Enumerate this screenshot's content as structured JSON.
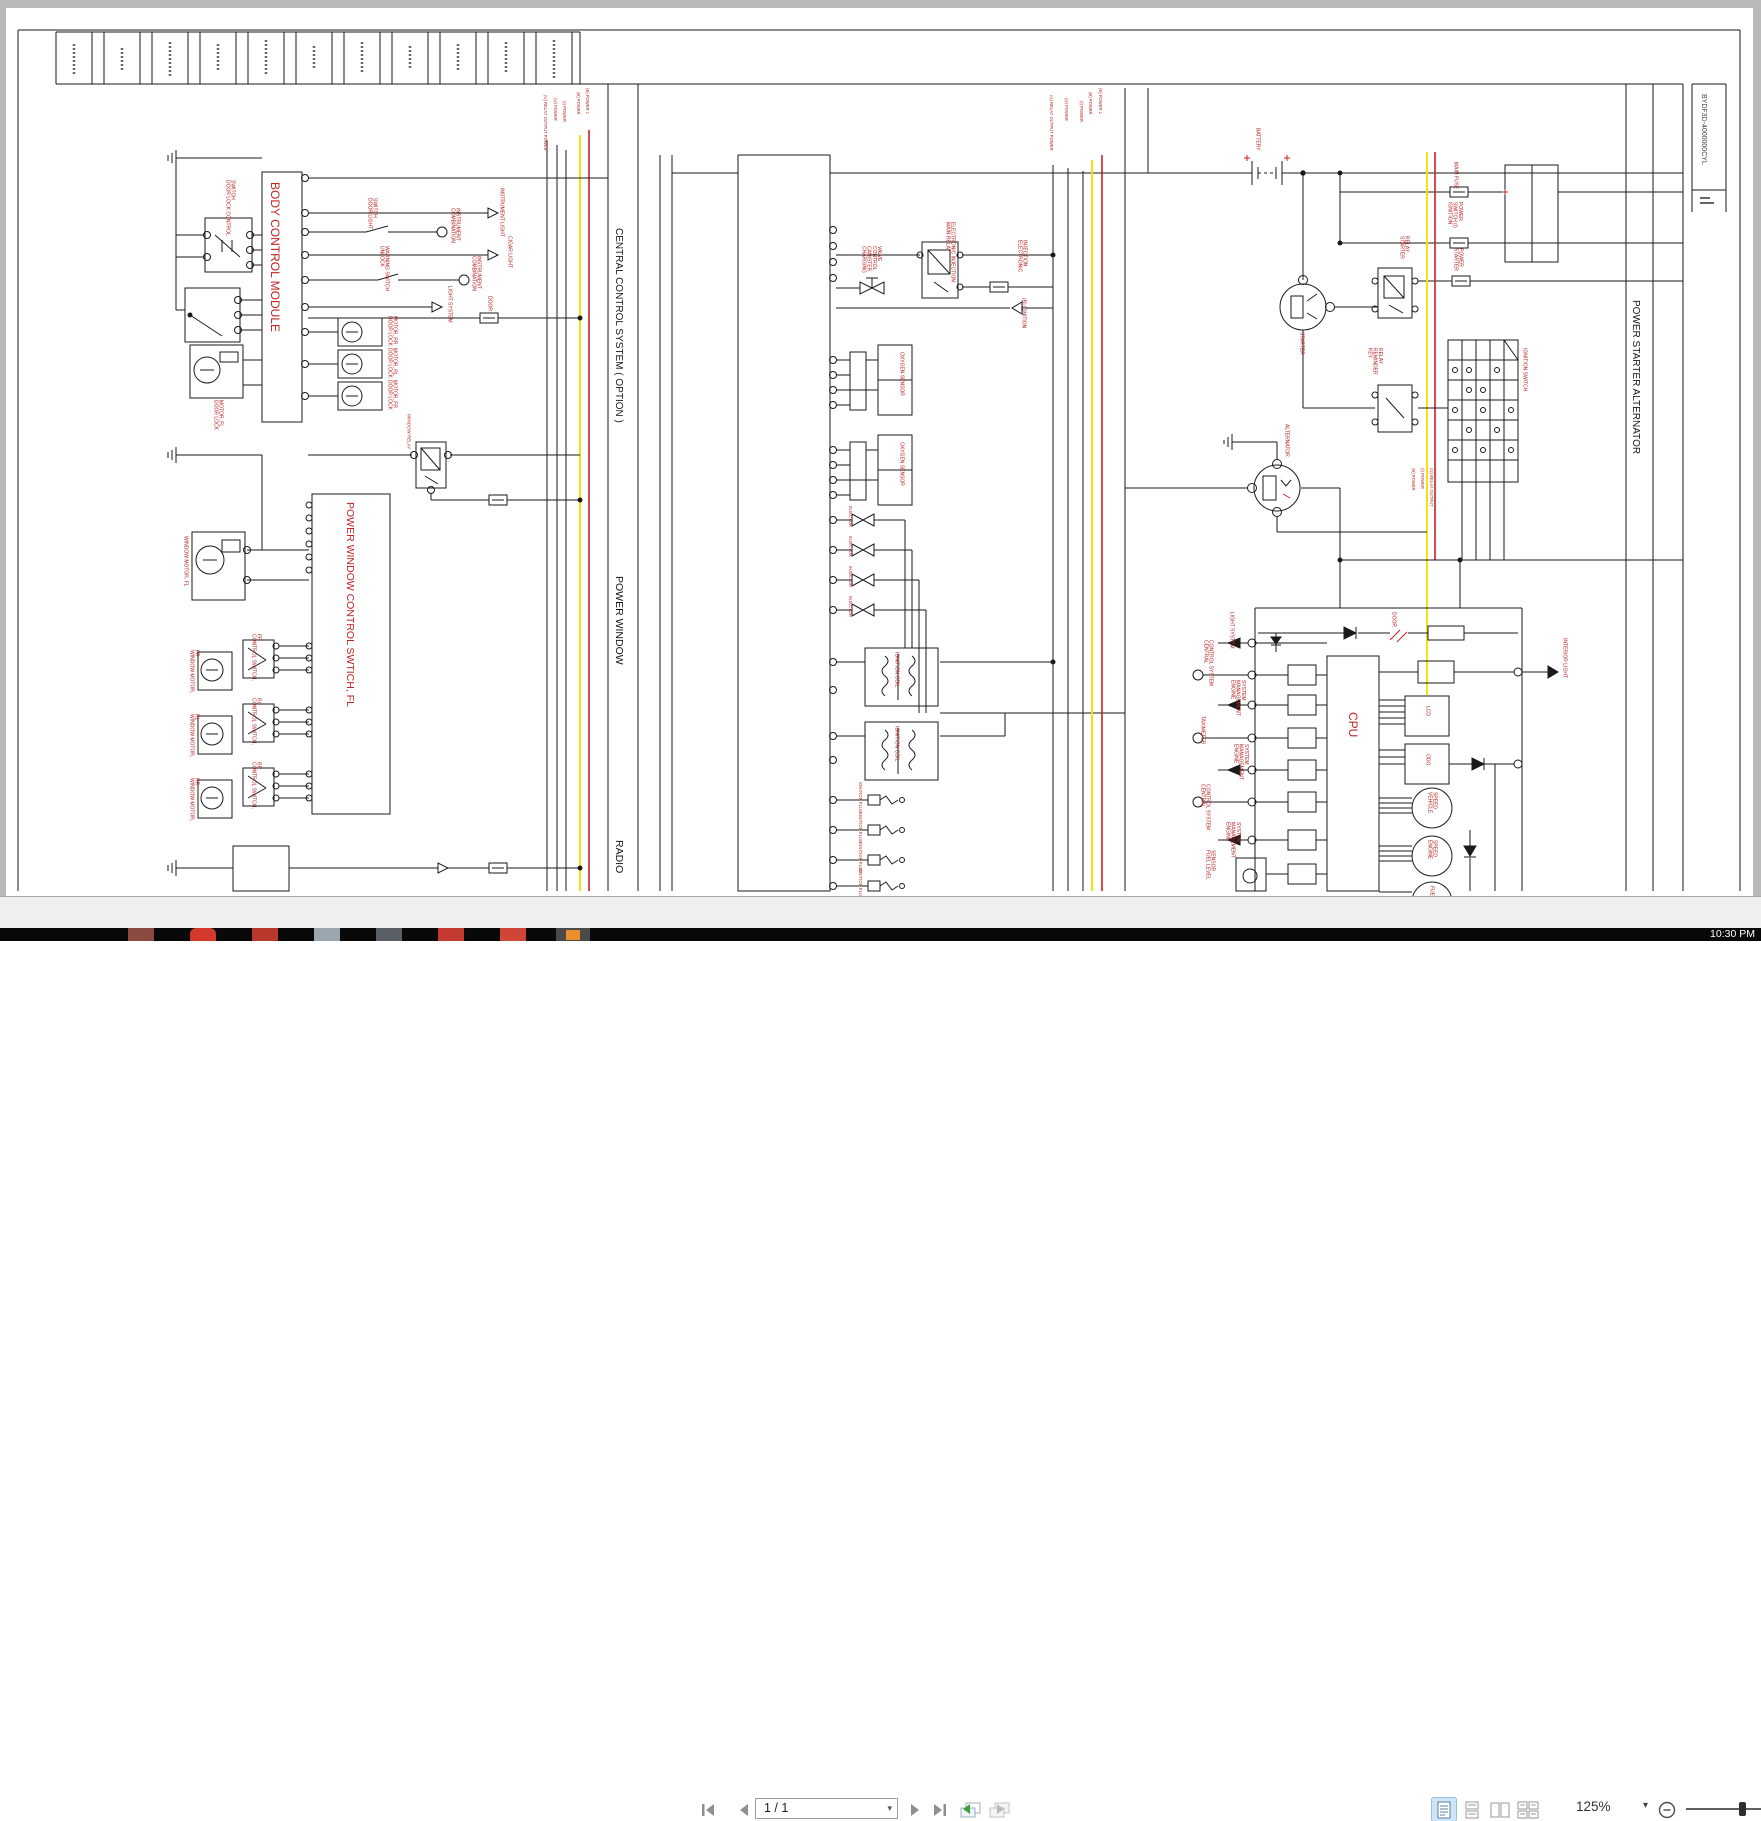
{
  "drawing": {
    "number": "BYDF3D-4000000CYL",
    "sections": {
      "central_control": "CENTRAL CONTROL SYSTEM ( OPTION )",
      "power_window": "POWER WINDOW",
      "radio": "RADIO",
      "power_starter_alternator": "POWER STARTER ALTERNATOR"
    },
    "bus_left": [
      "(U) RELAY OUTPUT POWER",
      "(U) POWER",
      "(I) POWER",
      "(B) POWER",
      "(B) POWER 1"
    ],
    "bus_mid": [
      "(U) RELAY OUTPUT POWER",
      "(U) POWER",
      "(I) POWER",
      "(B) POWER",
      "(B) POWER 1"
    ],
    "bus_right": [
      "(B) POWER",
      "(I) POWER",
      "(U) RELAY OUTPUT"
    ],
    "labels": {
      "bcm": "BODY CONTROL MODULE",
      "pwcs": "POWER WINDOW CONTROL SWTICH, FL",
      "door_lock_control_switch": "DOOR LOCK CONTROL SWITCH",
      "door_light_switch": "DOOR LIGHT SWITCH",
      "unlock_warning_switch": "UNLOCK WARNING SWITCH",
      "combination_instrument": "COMBINATION INSTRUMENT",
      "light_system": "LIGHT SYSTEM",
      "door": "DOOR",
      "instrument_light": "INSTRUMENT LIGHT",
      "cigar_light": "CIGAR LIGHT",
      "door_lock_motor_rr": "DOOR LOCK MOTOR, RR",
      "door_lock_motor_rl": "DOOR LOCK MOTOR, RL",
      "door_lock_motor_fr": "DOOR LOCK MOTOR, FR",
      "door_lock_motor_fl": "DOOR LOCK MOTOR, FL",
      "window_relay": "WINDOW RELAY",
      "window_motor_fl": "WINDOW MOTOR, FL",
      "window_motor_fr": "WINDOW MOTOR, FR",
      "window_motor_rl": "WINDOW MOTOR, RL",
      "window_motor_rr": "WINDOW MOTOR, RR",
      "control_switch_fr": "CONTROL SWITCH, FR",
      "control_switch_rl": "CONTROL SWITCH, RL",
      "control_switch_rr": "CONTROL SWITCH, RR",
      "main_relay": "MAIN RELAY ELECTRONIC INJECTION",
      "canister_valve": "CHARGING CANISTER CONTROL VALVE",
      "electronic_injection": "ELECTRONIC INJECTION",
      "ignition_b": "(B) IGNITION",
      "oxygen_sensor": "OXYGEN SENSOR",
      "injector": "INJECTOR",
      "ignition_coil": "IGNITION COIL",
      "ignition_plug": "IGNITION PLUG",
      "battery": "BATTERY",
      "main_fuse": "MAIN FUSE",
      "ignition_switch_power": "IGNITION SWITCH (I) POWER",
      "starter_power": "STARTER POWER",
      "starter": "STARTER",
      "starter_relay": "STARTER RELAY",
      "key_reminder_relay": "KEY REMINDER RELAY",
      "ignition_switch": "IGNITION SWITCH",
      "alternator": "ALTERNATOR",
      "cpu": "CPU",
      "lcd": "LCD",
      "odo": "ODO",
      "vehicle_speed": "VEHICLE SPEED",
      "engine_speed": "ENGINE SPEED",
      "fuel": "FUEL",
      "central_control_system": "CENTRAL CONTROL SYSTEM",
      "engine_management_system": "ENGINE MANAGEMENT SYSTEM",
      "taximeter": "TAXIMETER",
      "fuel_level_sensor": "FUEL LEVEL SENSOR",
      "interior_light": "INTERIOR LIGHT"
    },
    "colors": {
      "label_red": "#b92222",
      "wire_yellow": "#f0e40a",
      "wire_red": "#cc2020"
    }
  },
  "toolbar": {
    "page_indicator": "1 / 1",
    "zoom_level": "125%",
    "zoom_caret": "▾",
    "page_caret": "▾"
  },
  "taskbar": {
    "clock": "10:30 PM"
  }
}
